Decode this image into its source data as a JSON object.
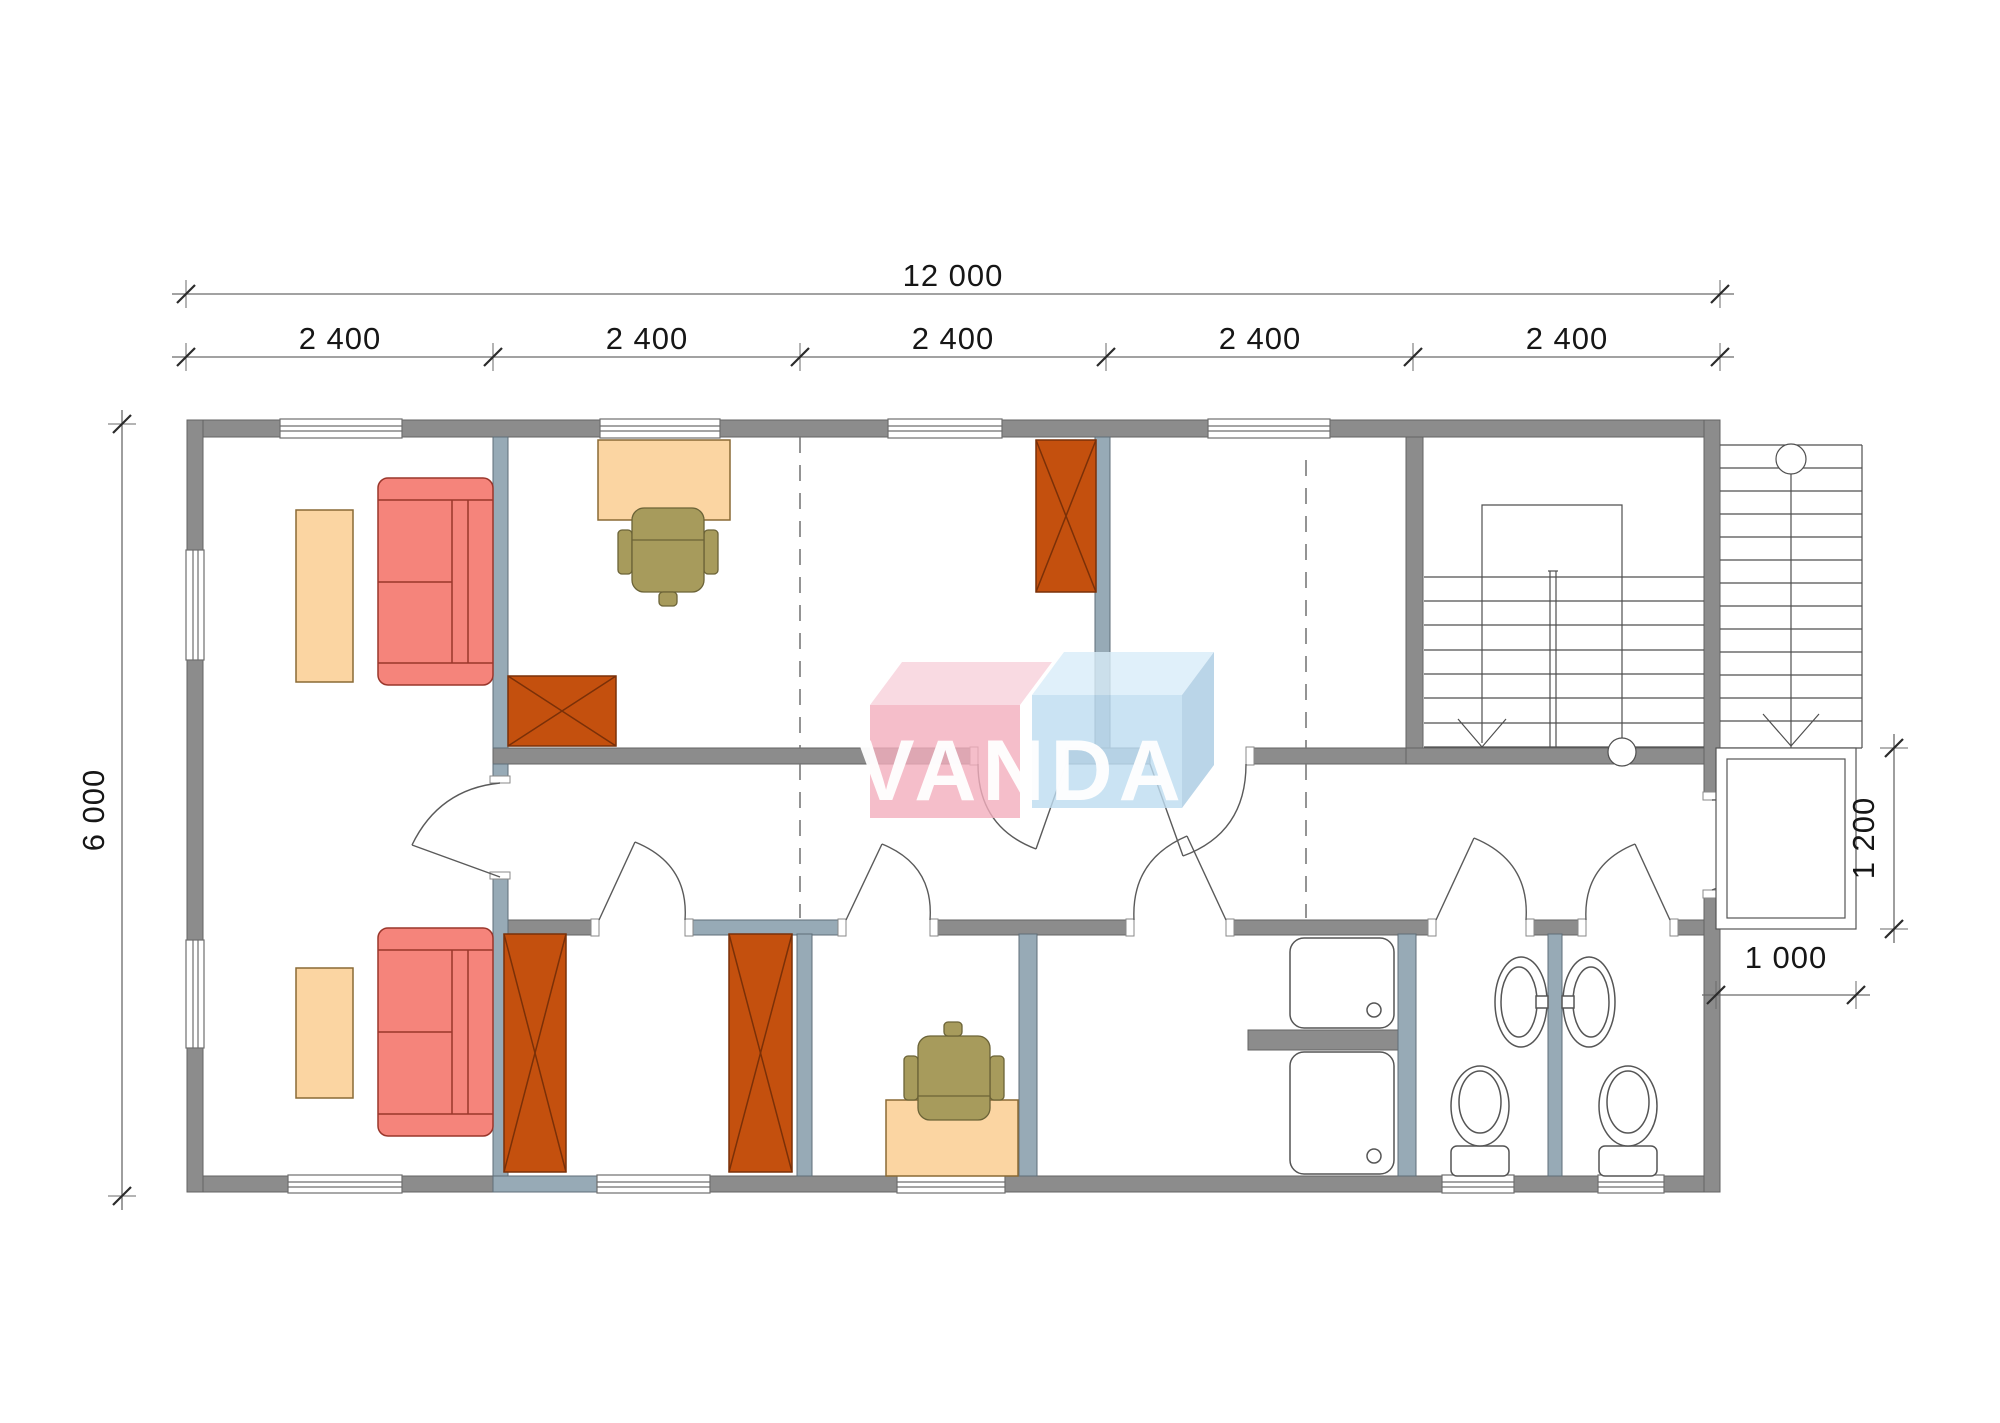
{
  "watermark": {
    "name": "VANDA",
    "left_box_front_color": "#F3AEBD",
    "left_box_top_color": "#F8D2DC",
    "right_box_front_color": "#BEDDF1",
    "right_box_top_color": "#D9EDF9",
    "right_box_side_color": "#A9CBE3"
  },
  "dimensions": {
    "total_width": {
      "label": "12 000"
    },
    "bays": [
      {
        "label": "2 400"
      },
      {
        "label": "2 400"
      },
      {
        "label": "2 400"
      },
      {
        "label": "2 400"
      },
      {
        "label": "2 400"
      }
    ],
    "total_depth": {
      "label": "6 000"
    },
    "porch_side": {
      "label": "1 200"
    },
    "porch_front": {
      "label": "1 000"
    }
  },
  "colors": {
    "exterior_wall": "#8C8C8C",
    "interior_wall": "#97AAB6",
    "wardrobe": "#C4500E",
    "sofa": "#F5847B",
    "table_desk": "#FBD5A2",
    "office_chair": "#A79B5C",
    "dimension_text": "#161616"
  }
}
